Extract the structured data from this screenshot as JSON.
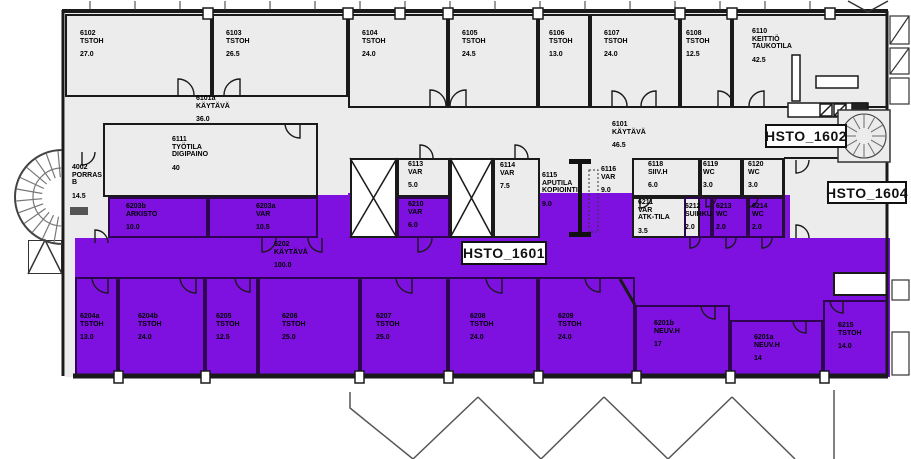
{
  "plan_name": "office-floor-plan",
  "colors": {
    "highlight": "#7E10E0",
    "highlight_wall": "#2E0450",
    "floor": "#ECECEC",
    "wall": "#1A1A1A"
  },
  "zones": [
    {
      "text": "HSTO_1601",
      "x": 461,
      "y": 241,
      "w": 86,
      "h": 24
    },
    {
      "text": "HSTO_1602",
      "x": 765,
      "y": 124,
      "w": 82,
      "h": 24
    },
    {
      "text": "HSTO_1604",
      "x": 827,
      "y": 181,
      "w": 80,
      "h": 23
    }
  ],
  "patches": [
    {
      "x": 108,
      "y": 195,
      "w": 240,
      "h": 43
    },
    {
      "x": 348,
      "y": 193,
      "w": 336,
      "h": 45
    },
    {
      "x": 684,
      "y": 195,
      "w": 106,
      "h": 43
    },
    {
      "x": 75,
      "y": 238,
      "w": 815,
      "h": 139
    }
  ],
  "rooms": [
    {
      "number": "6102",
      "name": "TSTOH",
      "area": "27.0",
      "x": 65,
      "y": 14,
      "w": 147,
      "h": 83,
      "fill": "gray",
      "lx": 80,
      "ly": 30
    },
    {
      "number": "6103",
      "name": "TSTOH",
      "area": "26.5",
      "x": 212,
      "y": 14,
      "w": 136,
      "h": 83,
      "fill": "gray",
      "lx": 226,
      "ly": 30
    },
    {
      "number": "6104",
      "name": "TSTOH",
      "area": "24.0",
      "x": 348,
      "y": 14,
      "w": 100,
      "h": 94,
      "fill": "gray",
      "lx": 362,
      "ly": 30
    },
    {
      "number": "6105",
      "name": "TSTOH",
      "area": "24.5",
      "x": 448,
      "y": 14,
      "w": 90,
      "h": 94,
      "fill": "gray",
      "lx": 462,
      "ly": 30
    },
    {
      "number": "6106",
      "name": "TSTOH",
      "area": "13.0",
      "x": 538,
      "y": 14,
      "w": 52,
      "h": 94,
      "fill": "gray",
      "lx": 549,
      "ly": 30
    },
    {
      "number": "6107",
      "name": "TSTOH",
      "area": "24.0",
      "x": 590,
      "y": 14,
      "w": 90,
      "h": 94,
      "fill": "gray",
      "lx": 604,
      "ly": 30
    },
    {
      "number": "6108",
      "name": "TSTOH",
      "area": "12.5",
      "x": 680,
      "y": 14,
      "w": 52,
      "h": 94,
      "fill": "gray",
      "lx": 686,
      "ly": 30
    },
    {
      "number": "6110",
      "name": "KEITTIÖ TAUKOTILA",
      "area": "42.5",
      "x": 732,
      "y": 14,
      "w": 156,
      "h": 94,
      "fill": "gray",
      "lx": 752,
      "ly": 28
    },
    {
      "number": "6101a",
      "name": "KÄYTÄVÄ",
      "area": "36.0",
      "x": 65,
      "y": 95,
      "w": 283,
      "h": 28,
      "fill": "none",
      "lx": 196,
      "ly": 95
    },
    {
      "number": "6101",
      "name": "KÄYTÄVÄ",
      "area": "46.5",
      "x": 590,
      "y": 108,
      "w": 100,
      "h": 50,
      "fill": "none",
      "lx": 612,
      "ly": 121
    },
    {
      "number": "6111",
      "name": "TYÖTILA DIGIPAINO",
      "area": "40",
      "x": 103,
      "y": 123,
      "w": 215,
      "h": 74,
      "fill": "gray",
      "lx": 172,
      "ly": 136
    },
    {
      "number": "4002",
      "name": "PORRAS B",
      "area": "14.5",
      "x": 65,
      "y": 150,
      "w": 38,
      "h": 60,
      "fill": "none",
      "lx": 72,
      "ly": 164
    },
    {
      "number": "6203b",
      "name": "ARKISTO",
      "area": "10.0",
      "x": 108,
      "y": 197,
      "w": 100,
      "h": 41,
      "fill": "purple",
      "lx": 126,
      "ly": 203
    },
    {
      "number": "6203a",
      "name": "VAR",
      "area": "10.5",
      "x": 208,
      "y": 197,
      "w": 110,
      "h": 41,
      "fill": "purple",
      "lx": 256,
      "ly": 203
    },
    {
      "number": "6113",
      "name": "VAR",
      "area": "5.0",
      "x": 397,
      "y": 158,
      "w": 53,
      "h": 39,
      "fill": "gray",
      "lx": 408,
      "ly": 161
    },
    {
      "number": "6210",
      "name": "VAR",
      "area": "6.0",
      "x": 397,
      "y": 197,
      "w": 53,
      "h": 41,
      "fill": "purple",
      "lx": 408,
      "ly": 201
    },
    {
      "number": "6114",
      "name": "VAR",
      "area": "7.5",
      "x": 493,
      "y": 158,
      "w": 47,
      "h": 80,
      "fill": "gray",
      "lx": 500,
      "ly": 162
    },
    {
      "number": "6115",
      "name": "APUTILA KOPIOINTI",
      "area": "9.0",
      "x": 540,
      "y": 165,
      "w": 40,
      "h": 60,
      "fill": "none",
      "lx": 542,
      "ly": 172
    },
    {
      "number": "6116",
      "name": "VAR",
      "area": "9.0",
      "x": 598,
      "y": 160,
      "w": 30,
      "h": 60,
      "fill": "none",
      "lx": 601,
      "ly": 166
    },
    {
      "number": "6118",
      "name": "SIIV.H",
      "area": "6.0",
      "x": 632,
      "y": 158,
      "w": 68,
      "h": 39,
      "fill": "gray",
      "lx": 648,
      "ly": 161
    },
    {
      "number": "6211",
      "name": "VAR ATK-TILA",
      "area": "3.5",
      "x": 632,
      "y": 197,
      "w": 68,
      "h": 41,
      "fill": "gray",
      "lx": 638,
      "ly": 199
    },
    {
      "number": "6119",
      "name": "WC",
      "area": "3.0",
      "x": 700,
      "y": 158,
      "w": 42,
      "h": 39,
      "fill": "gray",
      "lx": 703,
      "ly": 161
    },
    {
      "number": "6120",
      "name": "WC",
      "area": "3.0",
      "x": 742,
      "y": 158,
      "w": 42,
      "h": 39,
      "fill": "gray",
      "lx": 748,
      "ly": 161
    },
    {
      "number": "6212",
      "name": "SUIHKU",
      "area": "2.0",
      "x": 684,
      "y": 197,
      "w": 28,
      "h": 41,
      "fill": "purple",
      "lx": 685,
      "ly": 203
    },
    {
      "number": "6213",
      "name": "WC",
      "area": "2.0",
      "x": 712,
      "y": 197,
      "w": 36,
      "h": 41,
      "fill": "purple",
      "lx": 716,
      "ly": 203
    },
    {
      "number": "6214",
      "name": "WC",
      "area": "2.0",
      "x": 748,
      "y": 197,
      "w": 36,
      "h": 41,
      "fill": "purple",
      "lx": 752,
      "ly": 203
    },
    {
      "number": "6202",
      "name": "KÄYTÄVÄ",
      "area": "100.0",
      "x": 240,
      "y": 238,
      "w": 120,
      "h": 39,
      "fill": "none",
      "lx": 274,
      "ly": 241
    },
    {
      "number": "6204a",
      "name": "TSTOH",
      "area": "13.0",
      "x": 75,
      "y": 277,
      "w": 43,
      "h": 100,
      "fill": "purple",
      "lx": 80,
      "ly": 313
    },
    {
      "number": "6204b",
      "name": "TSTOH",
      "area": "24.0",
      "x": 118,
      "y": 277,
      "w": 87,
      "h": 100,
      "fill": "purple",
      "lx": 138,
      "ly": 313
    },
    {
      "number": "6205",
      "name": "TSTOH",
      "area": "12.5",
      "x": 205,
      "y": 277,
      "w": 53,
      "h": 100,
      "fill": "purple",
      "lx": 216,
      "ly": 313
    },
    {
      "number": "6206",
      "name": "TSTOH",
      "area": "25.0",
      "x": 258,
      "y": 277,
      "w": 102,
      "h": 100,
      "fill": "purple",
      "lx": 282,
      "ly": 313
    },
    {
      "number": "6207",
      "name": "TSTOH",
      "area": "25.0",
      "x": 360,
      "y": 277,
      "w": 88,
      "h": 100,
      "fill": "purple",
      "lx": 376,
      "ly": 313
    },
    {
      "number": "6208",
      "name": "TSTOH",
      "area": "24.0",
      "x": 448,
      "y": 277,
      "w": 90,
      "h": 100,
      "fill": "purple",
      "lx": 470,
      "ly": 313
    },
    {
      "number": "6209",
      "name": "TSTOH",
      "area": "24.0",
      "x": 538,
      "y": 277,
      "w": 97,
      "h": 100,
      "fill": "purple",
      "lx": 558,
      "ly": 313
    },
    {
      "number": "6201b",
      "name": "NEUV.H",
      "area": "17",
      "x": 635,
      "y": 305,
      "w": 95,
      "h": 72,
      "fill": "purple",
      "lx": 654,
      "ly": 320
    },
    {
      "number": "6201a",
      "name": "NEUV.H",
      "area": "14",
      "x": 730,
      "y": 320,
      "w": 93,
      "h": 57,
      "fill": "purple",
      "lx": 754,
      "ly": 334
    },
    {
      "number": "6215",
      "name": "TSTOH",
      "area": "14.0",
      "x": 823,
      "y": 300,
      "w": 65,
      "h": 77,
      "fill": "purple",
      "lx": 838,
      "ly": 322
    }
  ]
}
